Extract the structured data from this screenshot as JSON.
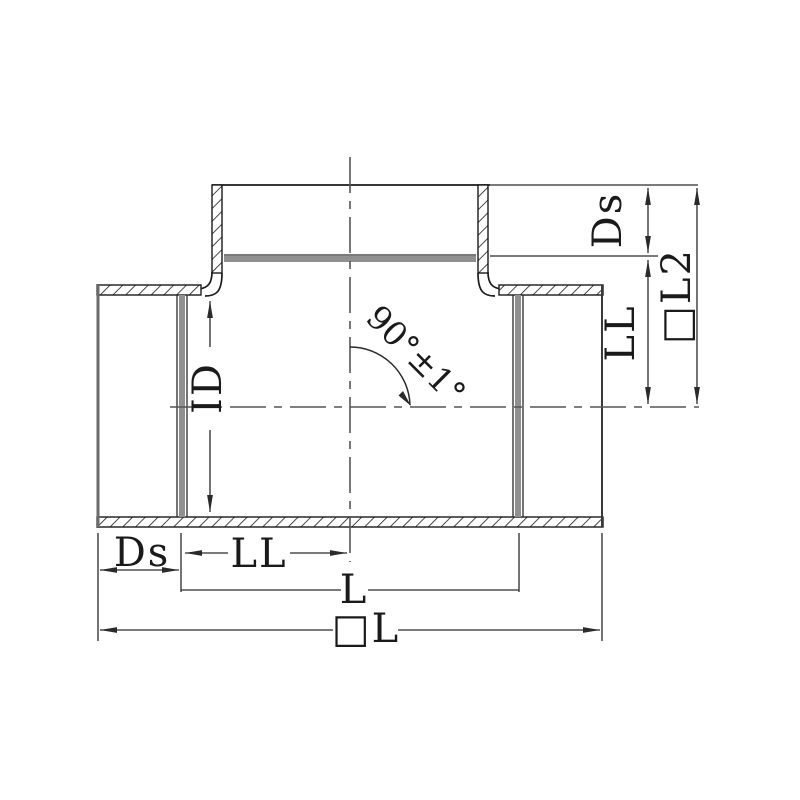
{
  "drawing": {
    "labels": {
      "angle": "90°±1°",
      "inner_diameter": "ID",
      "socket_depth_bottom": "Ds",
      "laying_length_bottom": "LL",
      "length_bottom": "L",
      "overall_length_bottom": "□L",
      "socket_depth_right": "Ds",
      "laying_length_right": "LL",
      "overall_length_right": "□L2"
    },
    "colors": {
      "outline": "#1a1a1a",
      "dimension_line": "#2a2a2a",
      "socket_depth_gray": "#909090",
      "centerline": "#555555",
      "background": "#ffffff"
    }
  }
}
